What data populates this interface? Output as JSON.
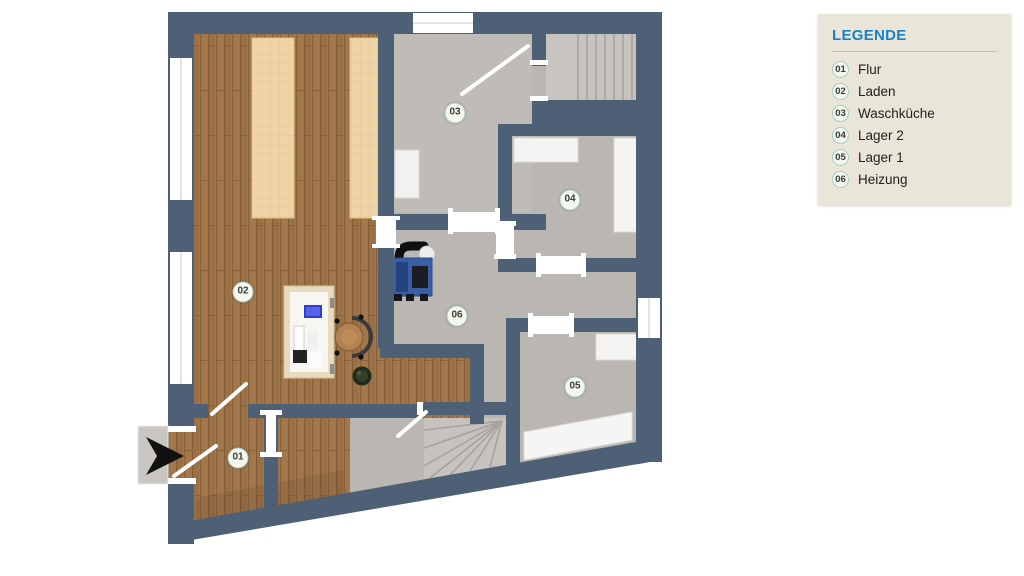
{
  "legend": {
    "title": "LEGENDE",
    "items": [
      {
        "id": "01",
        "label": "Flur"
      },
      {
        "id": "02",
        "label": "Laden"
      },
      {
        "id": "03",
        "label": "Waschküche"
      },
      {
        "id": "04",
        "label": "Lager 2"
      },
      {
        "id": "05",
        "label": "Lager 1"
      },
      {
        "id": "06",
        "label": "Heizung"
      }
    ]
  },
  "plan": {
    "rooms": [
      {
        "id": "01",
        "x": 238,
        "y": 458
      },
      {
        "id": "02",
        "x": 243,
        "y": 292
      },
      {
        "id": "03",
        "x": 455,
        "y": 113
      },
      {
        "id": "04",
        "x": 570,
        "y": 200
      },
      {
        "id": "05",
        "x": 575,
        "y": 387
      },
      {
        "id": "06",
        "x": 457,
        "y": 316
      }
    ],
    "colors": {
      "wall": "#4e6076",
      "floor": "#bab7b2",
      "wood": "#a1774b",
      "counter": "#efd5a5",
      "stairs": "#c6c3be",
      "legend_bg": "#e9e5d8",
      "accent": "#1a82c4"
    }
  }
}
